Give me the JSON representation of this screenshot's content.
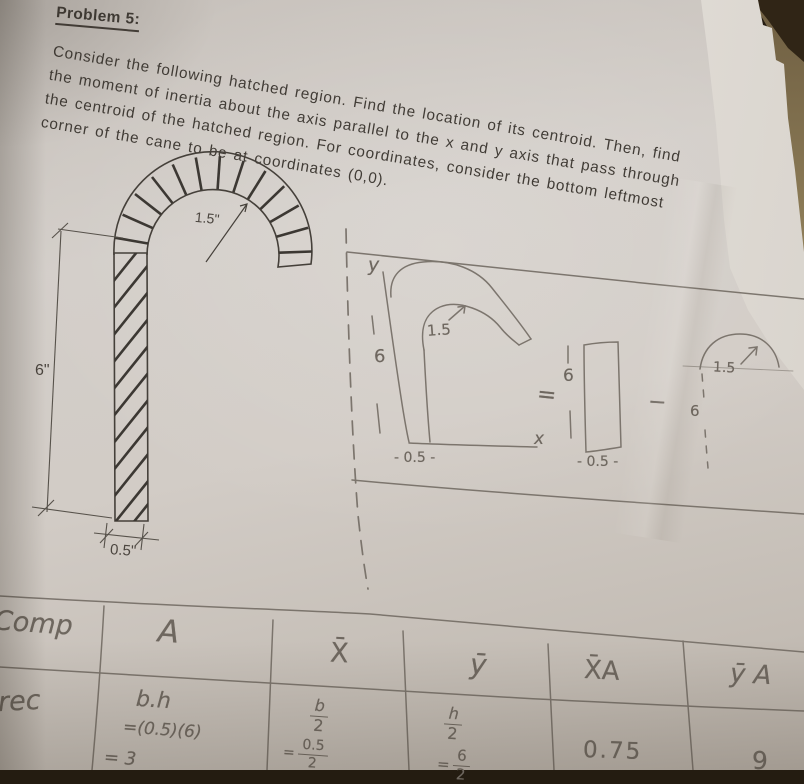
{
  "problem": {
    "title": "Problem 5:",
    "body_lines": [
      "Consider the following hatched region. Find the location of its centroid. Then, find",
      "the moment of inertia about the axis parallel to the x and y axis that pass through",
      "the centroid of the hatched region. For coordinates, consider the bottom leftmost",
      "corner of the cane to be at coordinates (0,0)."
    ]
  },
  "figure": {
    "radius_label": "1.5\"",
    "height_label": "6\"",
    "width_label": "0.5\""
  },
  "sketch": {
    "y_axis_label": "y",
    "x_axis_label": "x",
    "cane_radius_label": "1.5",
    "cane_height_label": "6",
    "cane_width_label": "- 0.5 -",
    "equals_sign": "=",
    "rect_height_label": "6",
    "rect_width_label": "- 0.5 -",
    "minus_sign": "−",
    "semi_radius_label": "1.5",
    "semi_height_label": "6"
  },
  "table": {
    "headers": {
      "comp": "Comp",
      "area": "A",
      "xbar": "X̄",
      "ybar": "ȳ",
      "xbar_a": "X̄A",
      "ybar_a": "ȳ A"
    },
    "row_rec": {
      "label": "rec",
      "area_formula": "b.h",
      "area_sub": "=(0.5)(6)",
      "area_value": "= 3",
      "xbar_num": "b",
      "xbar_den": "2",
      "xbar_eq": "=",
      "xbar_num2": "0.5",
      "xbar_den2": "2",
      "ybar_num": "h",
      "ybar_den": "2",
      "ybar_eq": "=",
      "ybar_num2": "6",
      "ybar_den2": "2",
      "xbar_a_value": "0.75",
      "ybar_a_value": "9"
    }
  },
  "colors": {
    "paper": "#cfc9c3",
    "pencil": "#6e675f",
    "printed_ink": "#413c36",
    "table_surface": "#97865f",
    "background": "#241c11"
  }
}
